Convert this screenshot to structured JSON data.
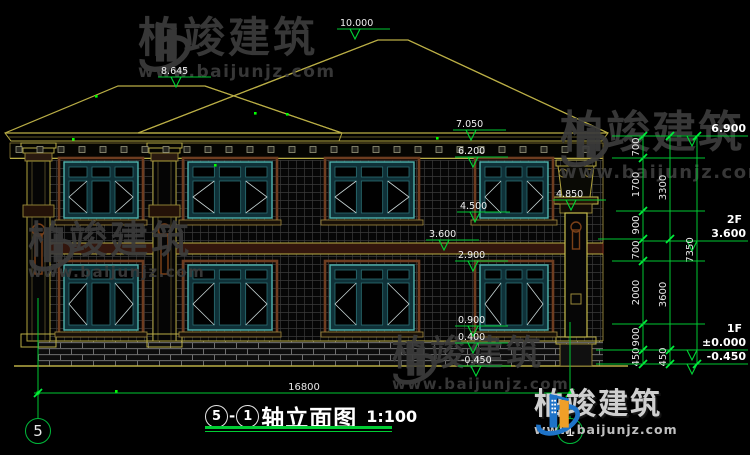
{
  "watermarks": {
    "brand": "柏竣建筑",
    "url": "www.baijunjz.com"
  },
  "title": {
    "axis_start": "5",
    "dash": "-",
    "axis_end": "1",
    "name": "轴立面图",
    "scale": "1:100"
  },
  "axis_bubbles": {
    "left": "5",
    "right": "1"
  },
  "annotations": {
    "elevations_left": [
      {
        "label": "10.000",
        "x": 340,
        "y": 17
      },
      {
        "label": "8.645",
        "x": 161,
        "y": 65
      },
      {
        "label": "7.050",
        "x": 456,
        "y": 118
      },
      {
        "label": "6.200",
        "x": 458,
        "y": 145
      },
      {
        "label": "4.850",
        "x": 556,
        "y": 188
      },
      {
        "label": "4.500",
        "x": 460,
        "y": 200
      },
      {
        "label": "3.600",
        "x": 429,
        "y": 228
      },
      {
        "label": "2.900",
        "x": 458,
        "y": 249
      },
      {
        "label": "0.900",
        "x": 458,
        "y": 314
      },
      {
        "label": "0.400",
        "x": 458,
        "y": 331
      },
      {
        "label": "-0.450",
        "x": 461,
        "y": 354
      }
    ],
    "elevations_right": [
      {
        "label": "6.900",
        "line_y": 136
      },
      {
        "label": "3.600",
        "floor": "2F",
        "line_y": 241
      },
      {
        "label": "±0.000",
        "floor": "1F",
        "line_y": 350
      },
      {
        "label": "-0.450",
        "line_y": 364
      }
    ],
    "dim_chains": [
      {
        "x": 643,
        "boundaries": [
          136,
          158,
          211,
          239,
          261,
          324,
          350,
          364
        ],
        "labels": [
          "700",
          "1700",
          "900",
          "700",
          "2000",
          "900",
          "450"
        ]
      },
      {
        "x": 670,
        "boundaries": [
          136,
          239,
          350,
          364
        ],
        "labels": [
          "3300",
          "3600",
          "450"
        ]
      },
      {
        "x": 697,
        "boundaries": [
          136,
          364
        ],
        "labels": [
          "7350"
        ]
      }
    ],
    "extension_lines": [
      {
        "y": 136,
        "x1": 612,
        "x2": 643
      },
      {
        "y": 158,
        "x1": 612,
        "x2": 705
      },
      {
        "y": 211,
        "x1": 616,
        "x2": 705
      },
      {
        "y": 239,
        "x1": 598,
        "x2": 643
      },
      {
        "y": 261,
        "x1": 612,
        "x2": 705
      },
      {
        "y": 324,
        "x1": 612,
        "x2": 705
      },
      {
        "y": 350,
        "x1": 596,
        "x2": 643
      },
      {
        "y": 364,
        "x1": 596,
        "x2": 643
      }
    ],
    "bottom_dim": {
      "label": "16800",
      "x1": 38,
      "x2": 570,
      "y": 393
    }
  },
  "drawing": {
    "windows": {
      "columns": [
        {
          "x": 64,
          "w": 74
        },
        {
          "x": 188,
          "w": 84
        },
        {
          "x": 330,
          "w": 84
        },
        {
          "x": 480,
          "w": 68
        }
      ],
      "floors": [
        {
          "y": 162,
          "h": 56,
          "transom": 0.3
        },
        {
          "y": 265,
          "h": 65,
          "transom": 0.24
        }
      ]
    }
  }
}
